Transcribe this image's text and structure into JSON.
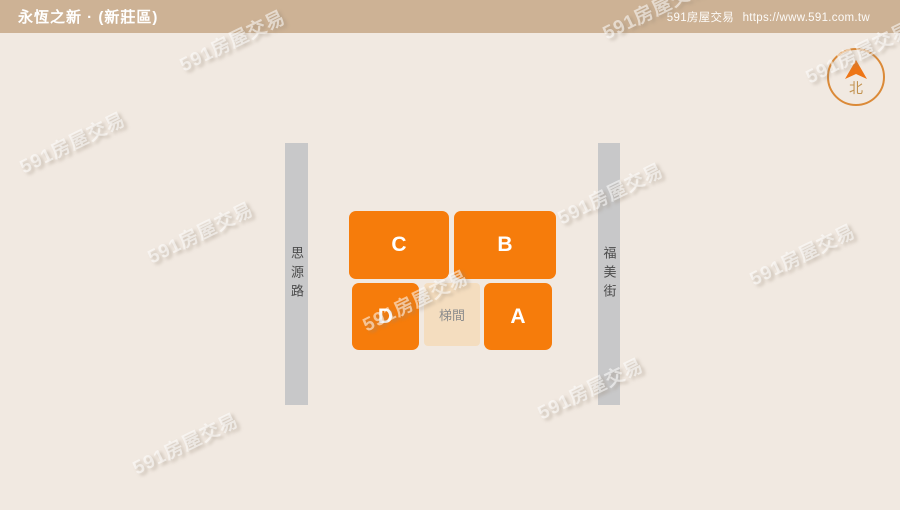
{
  "header": {
    "title": "永恆之新 · (新莊區)",
    "site_name": "591房屋交易",
    "site_url": "https://www.591.com.tw"
  },
  "compass": {
    "label": "北"
  },
  "roads": [
    {
      "name": "思源路",
      "side": "left"
    },
    {
      "name": "福美街",
      "side": "right"
    }
  ],
  "floorplan": {
    "units": [
      {
        "label": "C"
      },
      {
        "label": "B"
      },
      {
        "label": "D"
      },
      {
        "label": "A"
      }
    ],
    "stairwell_label": "梯間"
  },
  "watermark": {
    "text": "591房屋交易"
  },
  "colors": {
    "header_bg": "#cdb295",
    "page_bg": "#f1e9e1",
    "unit_orange": "#f67c0b",
    "stairwell_bg": "#f4ddbf",
    "road_gray": "#c8c8c9",
    "compass_ring": "#db8a38",
    "compass_arrow": "#ee7516"
  }
}
